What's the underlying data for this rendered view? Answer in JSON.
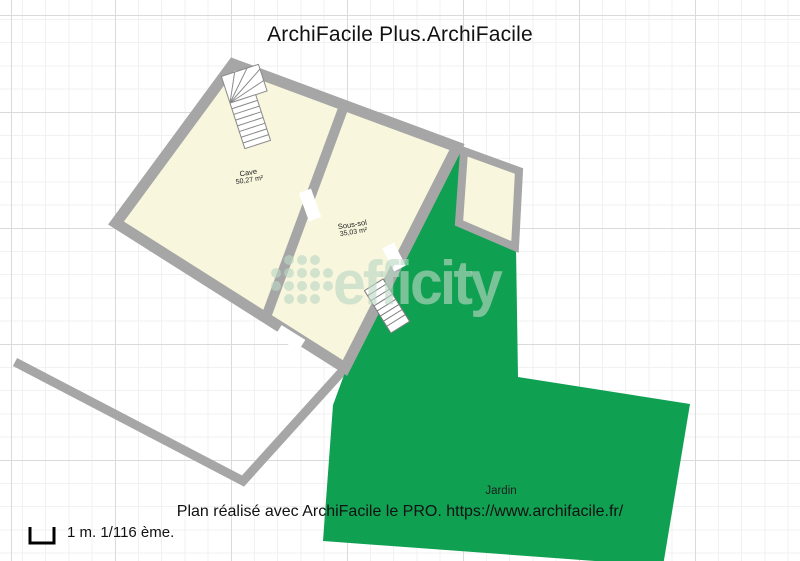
{
  "title": "ArchiFacile Plus.ArchiFacile",
  "watermark": {
    "brand": "efficity"
  },
  "rooms": {
    "cave": {
      "name": "Cave",
      "area": "50,27 m²"
    },
    "sous_sol": {
      "name": "Sous-sol",
      "area": "35,03 m²"
    },
    "jardin": {
      "name": "Jardin"
    }
  },
  "footer": {
    "credit": "Plan réalisé avec ArchiFacile le PRO. https://www.archifacile.fr/"
  },
  "scale": {
    "label": "1 m. 1/116 ème."
  },
  "colors": {
    "wall_gray": "#a6a6a6",
    "room_cream": "#f8f6dd",
    "garden_green": "#10a052",
    "watermark": "rgba(188,215,196,0.62)",
    "grid_minor": "#f1f1f1",
    "grid_major": "#dadada"
  }
}
